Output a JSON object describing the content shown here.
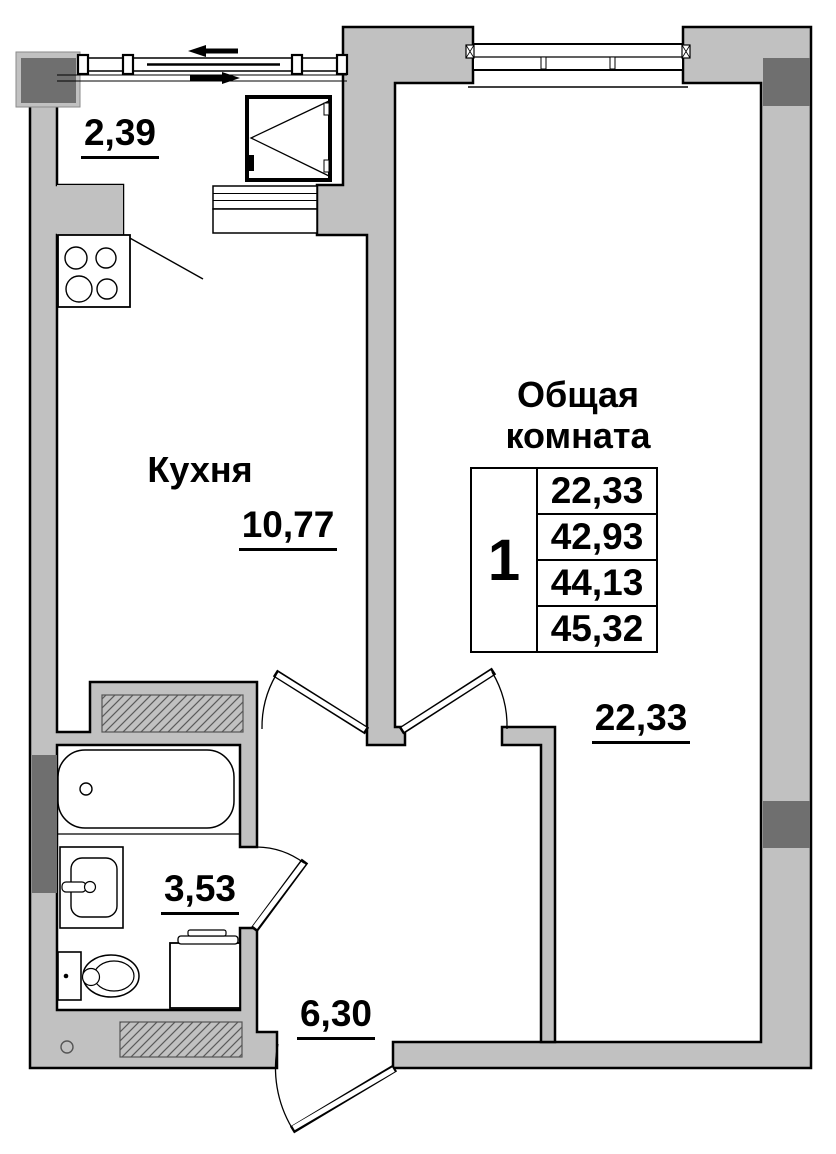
{
  "plan_title": "1-room apartment floor plan",
  "balcony": {
    "area": "2,39"
  },
  "kitchen": {
    "name": "Кухня",
    "area": "10,77"
  },
  "living_room": {
    "name_line1": "Общая",
    "name_line2": "комната",
    "area": "22,33"
  },
  "bathroom": {
    "area": "3,53"
  },
  "hallway": {
    "area": "6,30"
  },
  "stamp": {
    "rooms_count": "1",
    "rows": [
      "22,33",
      "42,93",
      "44,13",
      "45,32"
    ]
  },
  "colors": {
    "wall": "#c1c1c1",
    "column": "#6f6f6f",
    "line": "#000000",
    "hatch": "#5a5a5a"
  }
}
